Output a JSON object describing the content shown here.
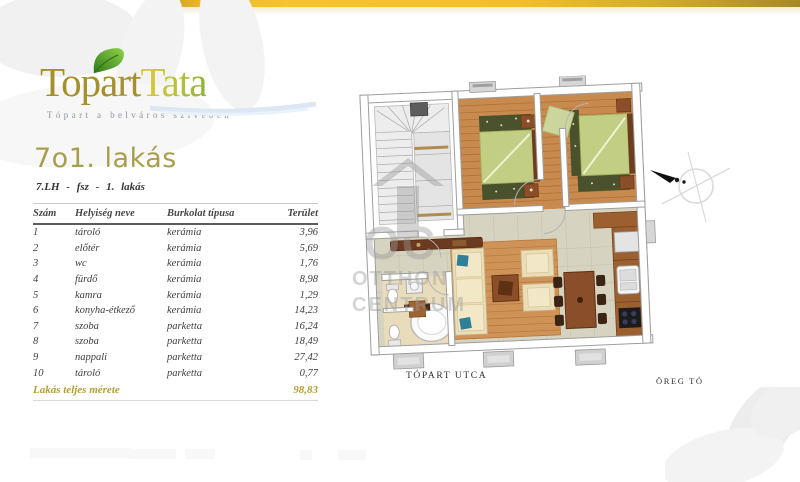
{
  "brand": {
    "logo_first": "Topart",
    "logo_second": "Tata",
    "tagline": "Tópart a belváros szívében"
  },
  "listing": {
    "title": "7o1. lakás",
    "subtitle": "7.LH - fsz - 1. lakás"
  },
  "table": {
    "headers": [
      "Szám",
      "Helyiség neve",
      "Burkolat típusa",
      "Terület"
    ],
    "rows": [
      {
        "num": "1",
        "name": "tároló",
        "surface": "kerámia",
        "area": "3,96"
      },
      {
        "num": "2",
        "name": "előtér",
        "surface": "kerámia",
        "area": "5,69"
      },
      {
        "num": "3",
        "name": "wc",
        "surface": "kerámia",
        "area": "1,76"
      },
      {
        "num": "4",
        "name": "fürdő",
        "surface": "kerámia",
        "area": "8,98"
      },
      {
        "num": "5",
        "name": "kamra",
        "surface": "kerámia",
        "area": "1,29"
      },
      {
        "num": "6",
        "name": "konyha-étkező",
        "surface": "kerámia",
        "area": "14,23"
      },
      {
        "num": "7",
        "name": "szoba",
        "surface": "parketta",
        "area": "16,24"
      },
      {
        "num": "8",
        "name": "szoba",
        "surface": "parketta",
        "area": "18,49"
      },
      {
        "num": "9",
        "name": "nappali",
        "surface": "parketta",
        "area": "27,42"
      },
      {
        "num": "10",
        "name": "tároló",
        "surface": "parketta",
        "area": "0,77"
      }
    ],
    "total_label": "Lakás teljes mérete",
    "total_value": "98,83"
  },
  "plan": {
    "street_label": "TÓPART UTCA",
    "lake_label": "ÖREG TÓ",
    "watermark": {
      "monogram": "OC",
      "line1": "OTTHON",
      "line2": "CENTRUM"
    }
  },
  "colors": {
    "gold_bar": "#f3c02a",
    "brand_gold": "#a5902e",
    "brand_green": "#8fb23a",
    "accent_gold": "#b19f34",
    "parquet": "#c98a4e",
    "tile": "#d7d3c1",
    "bed_green": "#c2ce84"
  }
}
